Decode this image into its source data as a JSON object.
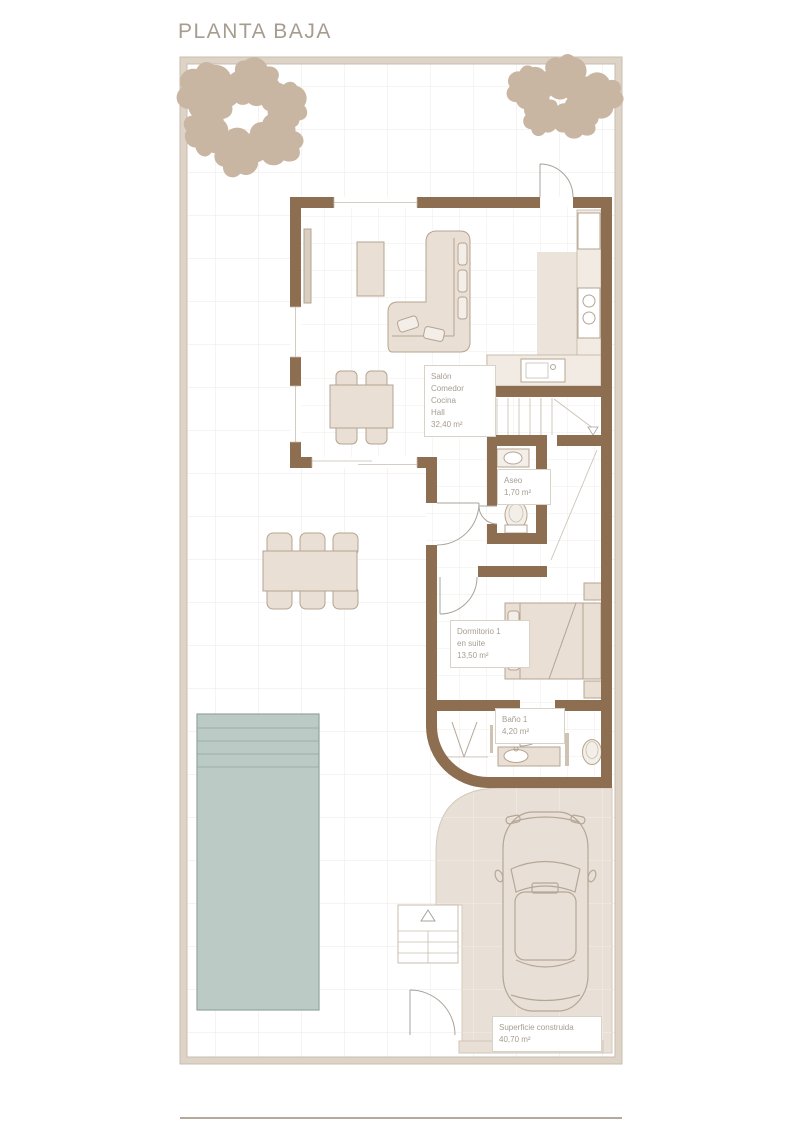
{
  "page": {
    "title": "PLANTA BAJA"
  },
  "rooms": {
    "salon": "Salón\nComedor\nCocina\nHall\n32,40 m²",
    "aseo": "Aseo\n1,70 m²",
    "dormitorio": "Dormitorio 1\nen suite\n13,50 m²",
    "bano": "Baño 1\n4,20 m²",
    "superficie": "Superficie construida\n40,70 m²"
  },
  "colors": {
    "wall": "#8e6e50",
    "furn": "#e9dfd4",
    "furn_stroke": "#b5a492",
    "floor_beige": "#e8e0d7",
    "kitchen_floor": "#ece3da",
    "pool": "#bccac5",
    "pool_stroke": "#93a5a0",
    "tree": "#c9b6a2",
    "frame_band": "#ddd4c7",
    "frame_edge": "#c9bdae",
    "grid_out": "#edeae5",
    "grid_in": "#f0ece7",
    "text": "#a69d90",
    "label_border": "#d9d2c9"
  }
}
